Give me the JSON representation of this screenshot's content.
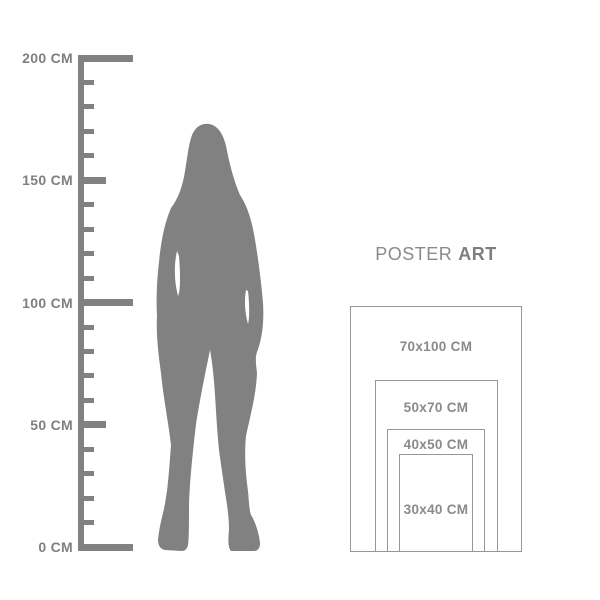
{
  "title": {
    "regular": "POSTER",
    "bold": "ART"
  },
  "ruler": {
    "unit": "CM",
    "min_cm": 0,
    "max_cm": 200,
    "tick_step_cm": 10,
    "long_tick_cm": [
      0,
      100,
      200
    ],
    "medium_tick_cm": [
      50,
      150
    ],
    "labels": [
      {
        "text": "200 CM",
        "cm": 200
      },
      {
        "text": "150 CM",
        "cm": 150
      },
      {
        "text": "100 CM",
        "cm": 100
      },
      {
        "text": "50 CM",
        "cm": 50
      },
      {
        "text": "0 CM",
        "cm": 0
      }
    ]
  },
  "figure": {
    "type": "standing-woman-silhouette"
  },
  "poster_sizes": [
    {
      "label": "70x100 CM",
      "w_cm": 70,
      "h_cm": 100
    },
    {
      "label": "50x70 CM",
      "w_cm": 50,
      "h_cm": 70
    },
    {
      "label": "40x50 CM",
      "w_cm": 40,
      "h_cm": 50
    },
    {
      "label": "30x40 CM",
      "w_cm": 30,
      "h_cm": 40
    }
  ],
  "colors": {
    "background": "#ffffff",
    "silhouette": "#818181",
    "ruler": "#818181",
    "ruler_label_text": "#7f7f7f",
    "poster_label_text": "#8a8a8a",
    "rect_border": "#979797"
  }
}
